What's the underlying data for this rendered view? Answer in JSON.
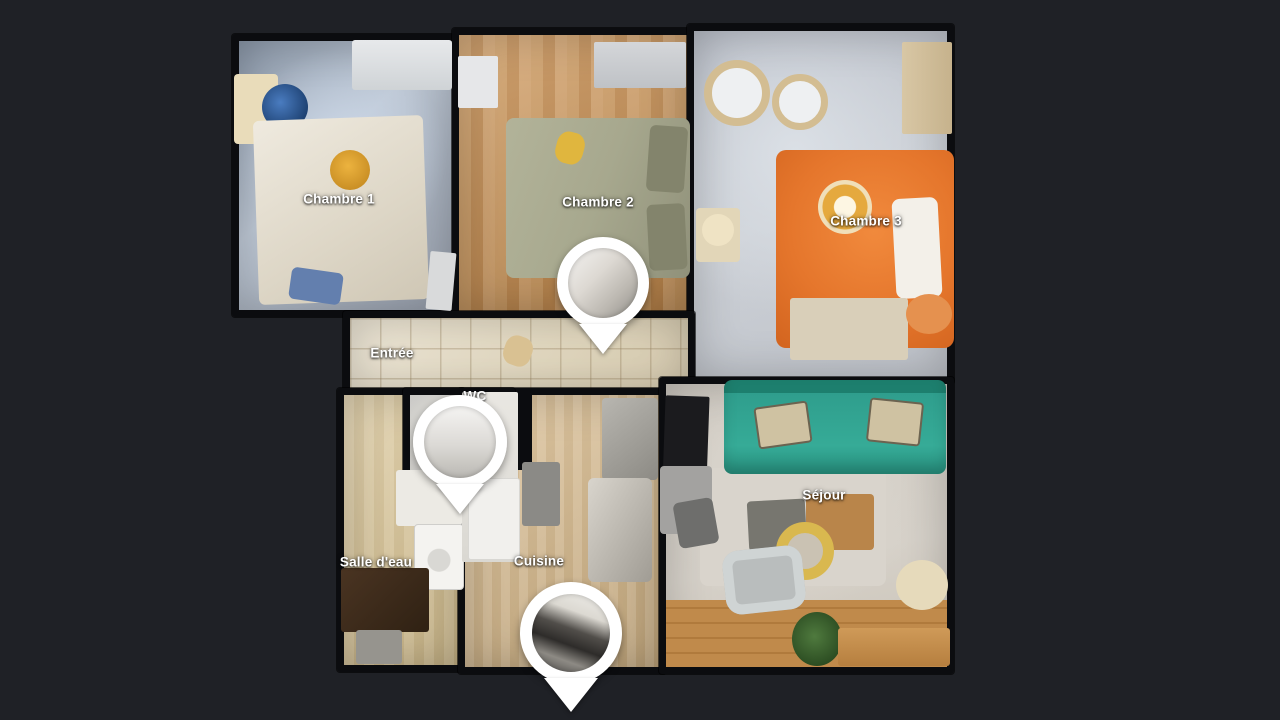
{
  "scene": {
    "description": "Top-down 3D dollhouse floor plan of an apartment in a virtual tour viewer"
  },
  "colors": {
    "background": "#1f2126",
    "wall": "#0b0c0f",
    "label_text": "#ffffff",
    "marker_white": "#ffffff",
    "sofa_teal": "#2f9e8d",
    "bed_orange": "#e5762c",
    "bed_sage": "#a7a88e",
    "wood_warm": "#c79257",
    "wood_pale": "#d7bc92",
    "tile_floor": "#e9e2d0",
    "cool_floor": "#b4bfcd"
  },
  "rooms": {
    "chambre1": {
      "label": "Chambre 1"
    },
    "chambre2": {
      "label": "Chambre 2"
    },
    "chambre3": {
      "label": "Chambre 3"
    },
    "entree": {
      "label": "Entrée"
    },
    "wc": {
      "label": "WC"
    },
    "salledeau": {
      "label": "Salle d'eau"
    },
    "cuisine": {
      "label": "Cuisine"
    },
    "sejour": {
      "label": "Séjour"
    }
  },
  "markers": [
    {
      "name": "pano-marker-chambre-2"
    },
    {
      "name": "pano-marker-wc"
    },
    {
      "name": "pano-marker-cuisine"
    }
  ]
}
